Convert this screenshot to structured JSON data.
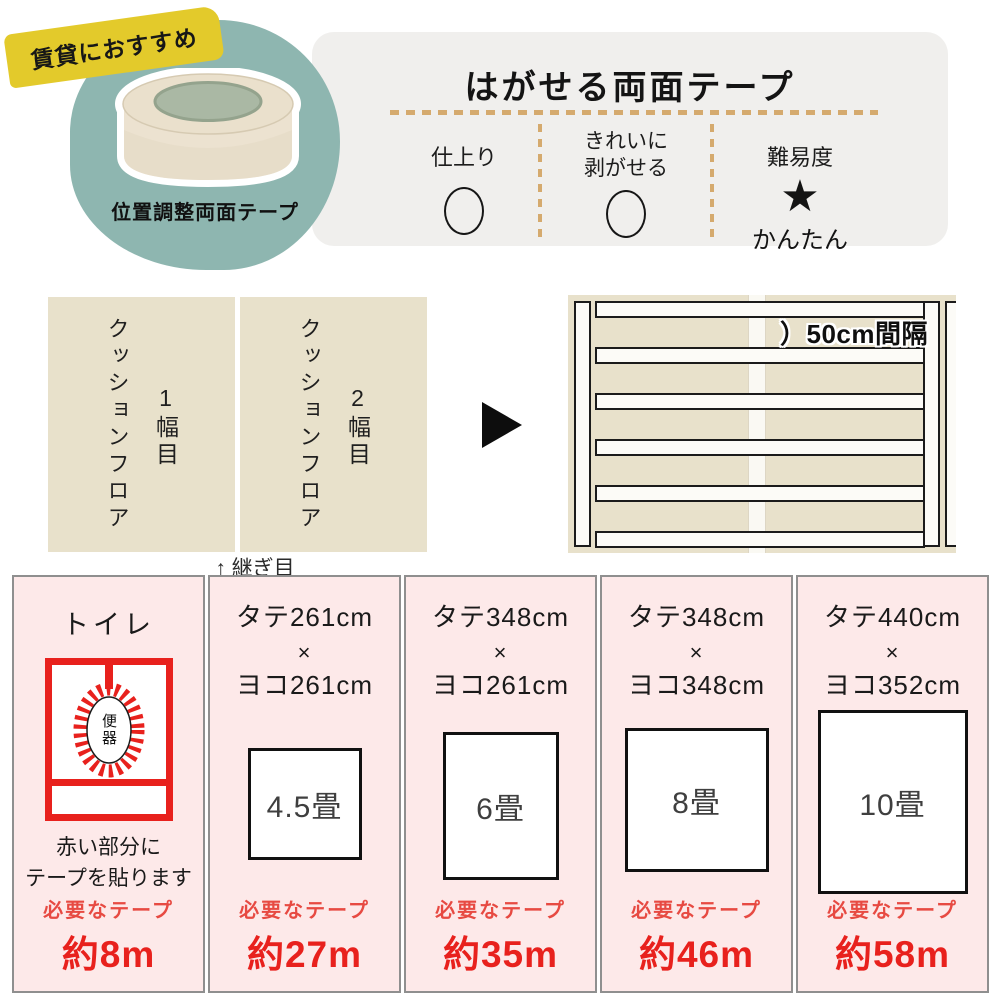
{
  "hero": {
    "badge_label": "賃貸におすすめ",
    "product_label": "位置調整両面テープ"
  },
  "spec_panel": {
    "title": "はがせる両面テープ",
    "features": [
      {
        "label": "仕上り",
        "rating": "○"
      },
      {
        "label_line1": "きれいに",
        "label_line2": "剥がせる",
        "rating": "○"
      },
      {
        "label": "難易度",
        "rating": "★",
        "caption": "かんたん"
      }
    ]
  },
  "installation": {
    "strips": [
      {
        "name": "クッションフロア",
        "order": "1幅目"
      },
      {
        "name": "クッションフロア",
        "order": "2幅目"
      }
    ],
    "seam_note": "↑ 継ぎ目",
    "spacing_label": "）50cm間隔"
  },
  "tape_requirements": {
    "toilet": {
      "title": "トイレ",
      "fixture_label": "便器",
      "note_line1": "赤い部分に",
      "note_line2": "テープを貼ります",
      "tape_label": "必要なテープ",
      "tape_amount": "約8m"
    },
    "rooms": [
      {
        "length": "タテ261cm",
        "multiply": "×",
        "width": "ヨコ261cm",
        "size": "4.5畳",
        "tape_label": "必要なテープ",
        "tape_amount": "約27m"
      },
      {
        "length": "タテ348cm",
        "multiply": "×",
        "width": "ヨコ261cm",
        "size": "6畳",
        "tape_label": "必要なテープ",
        "tape_amount": "約35m"
      },
      {
        "length": "タテ348cm",
        "multiply": "×",
        "width": "ヨコ348cm",
        "size": "8畳",
        "tape_label": "必要なテープ",
        "tape_amount": "約46m"
      },
      {
        "length": "タテ440cm",
        "multiply": "×",
        "width": "ヨコ352cm",
        "size": "10畳",
        "tape_label": "必要なテープ",
        "tape_amount": "約58m"
      }
    ]
  },
  "colors": {
    "teal_blob": "#8eb6b0",
    "badge_yellow": "#e3ca2b",
    "panel_gray": "#f0efed",
    "dash_tan": "#d5aa6e",
    "floor_beige": "#e8e1cb",
    "pink_background": "#fde9e9",
    "accent_red": "#e8211d"
  }
}
